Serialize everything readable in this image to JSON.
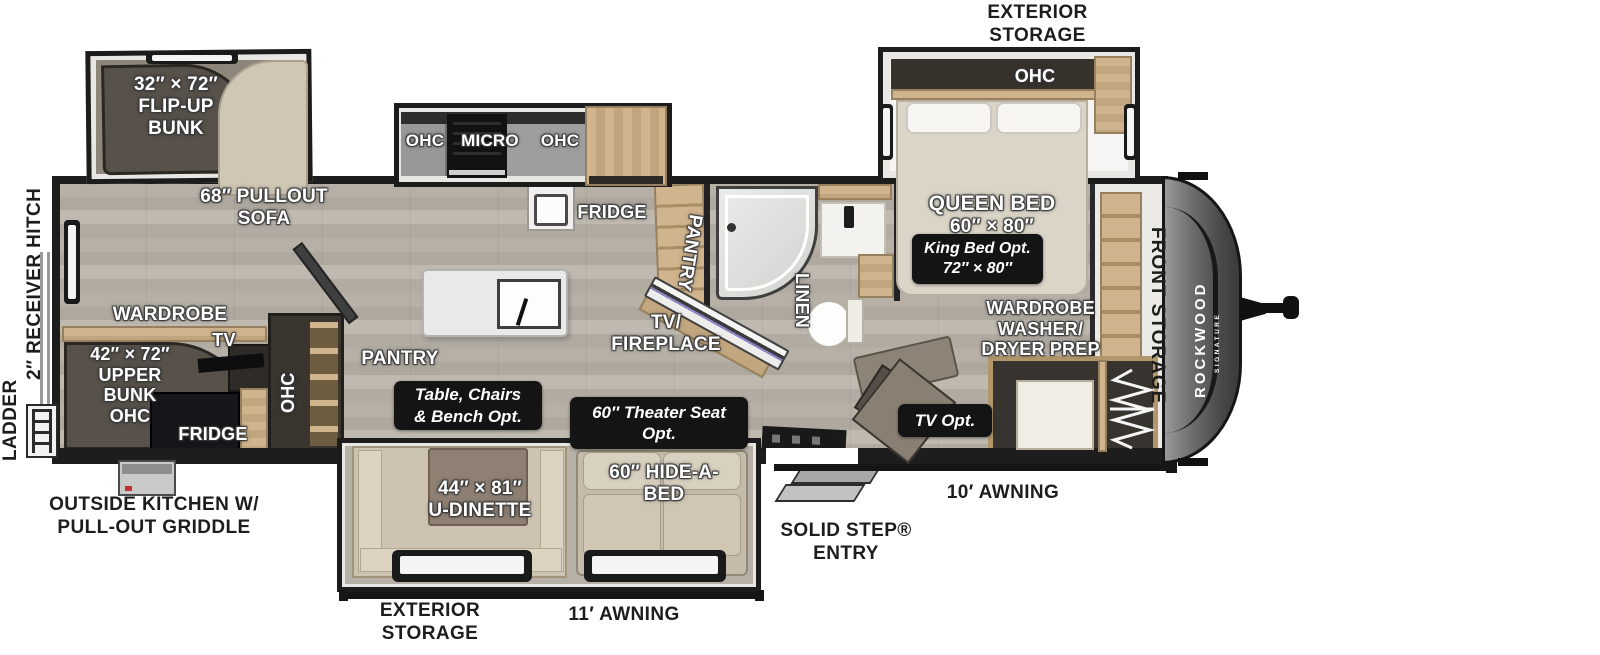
{
  "brand": {
    "name": "ROCKWOOD",
    "sub": "SIGNATURE"
  },
  "colors": {
    "badge_bg": "#141414",
    "wood": "#c9ae86",
    "floor": "#b3ada4",
    "front_cap": "#4a4a4a",
    "fireplace_stripe": "#8d82c4",
    "wall": "#1d1d1d"
  },
  "exterior": {
    "exterior_storage_top": "EXTERIOR\nSTORAGE",
    "ladder": "LADDER",
    "receiver_hitch": "2″ RECEIVER HITCH",
    "outside_kitchen": "OUTSIDE KITCHEN W/\nPULL-OUT GRIDDLE",
    "exterior_storage_bottom": "EXTERIOR\nSTORAGE",
    "awning_11": "11′ AWNING",
    "solid_step_entry": "SOLID STEP®\nENTRY",
    "awning_10": "10′ AWNING",
    "front_storage": "FRONT STORAGE"
  },
  "bunk_room": {
    "flip_up_bunk": "32″ × 72″\nFLIP-UP\nBUNK",
    "pullout_sofa": "68″ PULLOUT\nSOFA",
    "wardrobe": "WARDROBE",
    "upper_bunk": "42″ × 72″\nUPPER\nBUNK\nOHC",
    "tv": "TV",
    "fridge": "FRIDGE",
    "ohc": "OHC"
  },
  "kitchen": {
    "ohc_left": "OHC",
    "micro": "MICRO",
    "ohc_right": "OHC",
    "fridge": "FRIDGE",
    "pantry": "PANTRY"
  },
  "living": {
    "tv_fireplace": "TV/\nFIREPLACE",
    "table_chairs_opt": "Table, Chairs\n& Bench  Opt.",
    "u_dinette": "44″ × 81″\nU-DINETTE",
    "theater_seat_opt": "60″ Theater Seat\nOpt.",
    "hide_a_bed": "60″ HIDE-A-\nBED"
  },
  "bathroom": {
    "pantry": "PANTRY",
    "linen": "LINEN"
  },
  "bedroom": {
    "ohc": "OHC",
    "queen_title": "QUEEN BED",
    "queen_size": "60″ × 80″",
    "king_bed_opt": "King Bed Opt.\n72″ × 80″",
    "wardrobe_wd": "WARDROBE\nWASHER/\nDRYER PREP",
    "tv_opt": "TV Opt."
  }
}
